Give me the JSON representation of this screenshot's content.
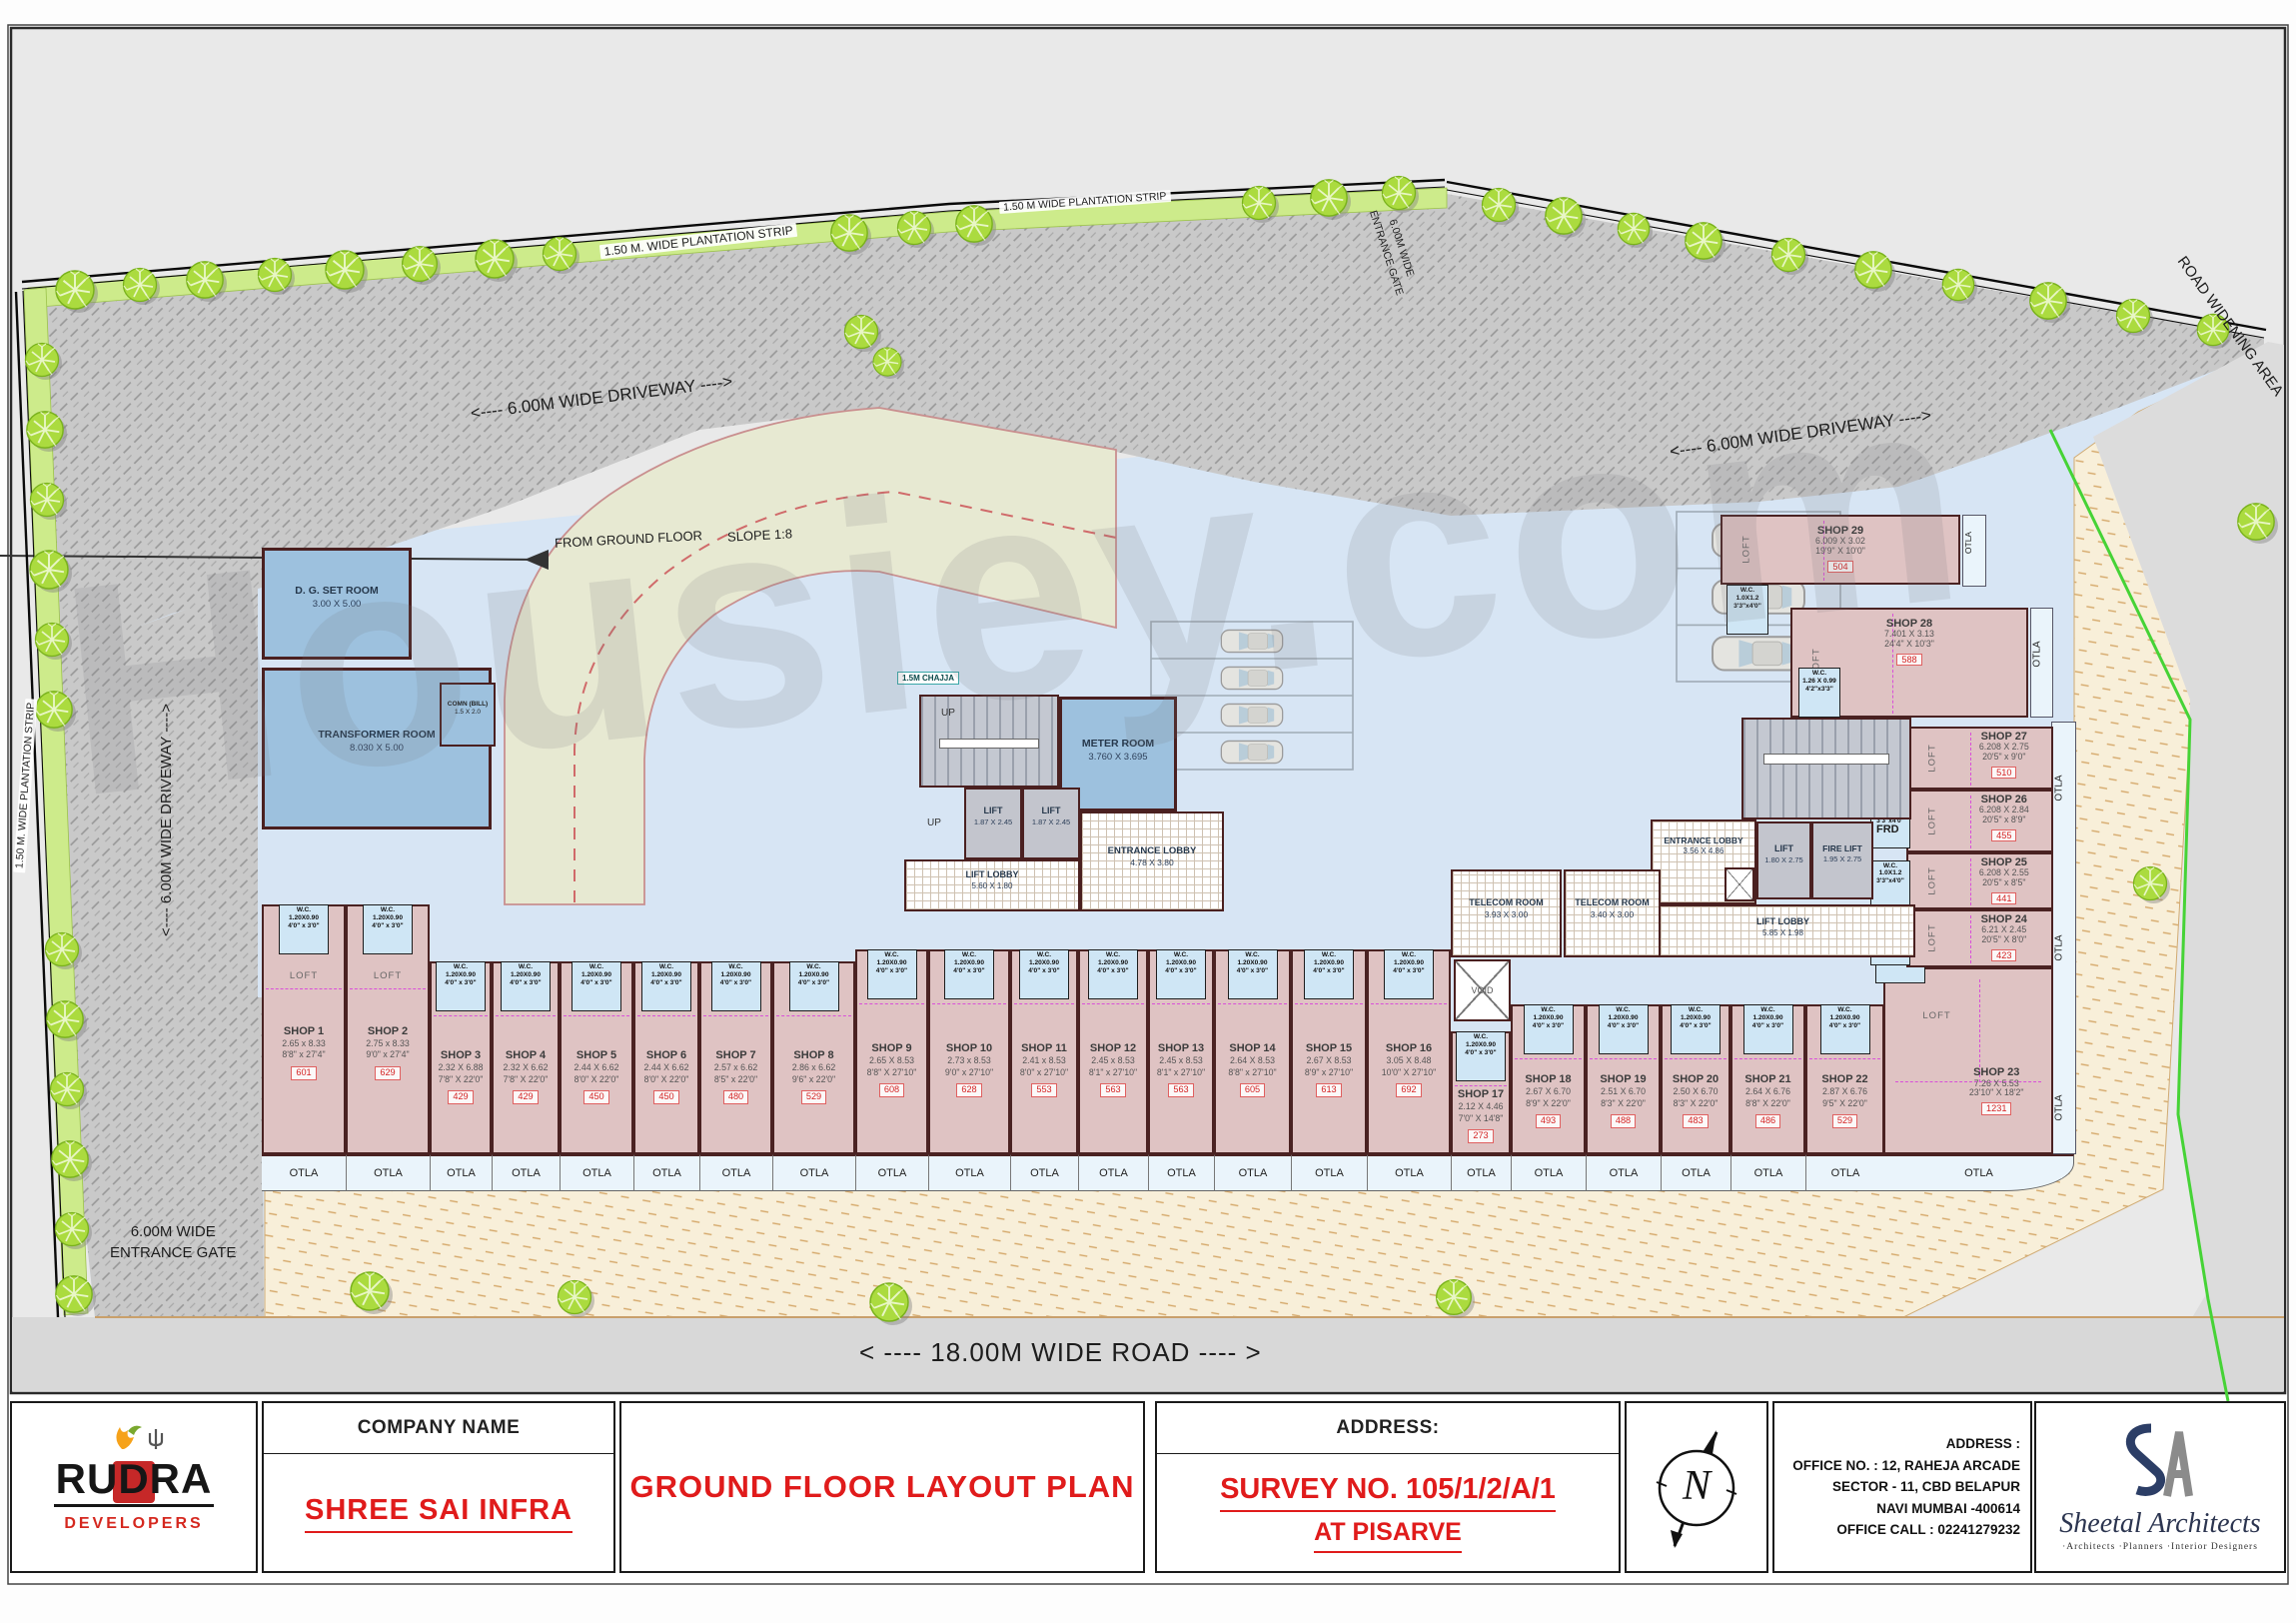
{
  "document": {
    "watermark": "Housiey.com"
  },
  "titleblock": {
    "developer_name": "RUDRA",
    "developer_sub": "DEVELOPERS",
    "company_label": "COMPANY NAME",
    "company_name": "SHREE SAI INFRA",
    "drawing_title": "GROUND FLOOR LAYOUT PLAN",
    "address_label": "ADDRESS:",
    "survey_line1": "SURVEY NO. 105/1/2/A/1",
    "survey_line2": "AT PISARVE",
    "north_letter": "N",
    "architect": {
      "addr_label": "ADDRESS :",
      "addr_line1": "OFFICE NO. : 12, RAHEJA ARCADE",
      "addr_line2": "SECTOR - 11, CBD BELAPUR",
      "addr_line3": "NAVI MUMBAI -400614",
      "addr_line4": "OFFICE CALL : 02241279232",
      "name": "Sheetal Architects",
      "tags": "·Architects    ·Planners    ·Interior Designers"
    }
  },
  "site": {
    "labels": {
      "plantation_strip": "1.50 M. WIDE PLANTATION STRIP",
      "plantation_strip_short": "1.50 M WIDE PLANTATION STRIP",
      "driveway": "<---- 6.00M WIDE DRIVEWAY ---->",
      "ramp_from": "FROM GROUND FLOOR",
      "ramp_slope": "SLOPE 1:8",
      "entrance_gate_line1": "6.00M WIDE",
      "entrance_gate_line2": "ENTRANCE GATE",
      "road_widening": "ROAD WIDENING AREA",
      "road": "< ---- 18.00M WIDE ROAD ---- >",
      "chajja": "1.5M CHAJJA",
      "void": "VOID",
      "frd": "FRD",
      "up": "UP",
      "otla": "OTLA",
      "loft": "LOFT"
    },
    "rooms": {
      "dg": {
        "name": "D. G. SET ROOM",
        "dim": "3.00 X 5.00"
      },
      "transformer": {
        "name": "TRANSFORMER ROOM",
        "dim": "8.030 X 5.00"
      },
      "comn": {
        "name": "COMN (BILL)",
        "dim": "1.5 X 2.0"
      },
      "meter": {
        "name": "METER ROOM",
        "dim": "3.760 X 3.695"
      },
      "telecom1": {
        "name": "TELECOM ROOM",
        "dim": "3.93 X 3.00"
      },
      "telecom2": {
        "name": "TELECOM ROOM",
        "dim": "3.40 X 3.00"
      }
    },
    "core_left": {
      "lift1": {
        "name": "LIFT",
        "dim": "1.87 X 2.45"
      },
      "lift2": {
        "name": "LIFT",
        "dim": "1.87 X 2.45"
      },
      "entrance_lobby": {
        "name": "ENTRANCE LOBBY",
        "dim": "4.78 X 3.80"
      },
      "lift_lobby": {
        "name": "LIFT LOBBY",
        "dim": "5.60 X 1.80"
      }
    },
    "core_right": {
      "lift": {
        "name": "LIFT",
        "dim": "1.80 X 2.75"
      },
      "fire_lift": {
        "name": "FIRE LIFT",
        "dim": "1.95 X 2.75"
      },
      "entrance_lobby": {
        "name": "ENTRANCE LOBBY",
        "dim": "3.56 X 4.86"
      },
      "lift_lobby": {
        "name": "LIFT LOBBY",
        "dim": "5.85 X 1.98"
      }
    },
    "wc": {
      "std": {
        "title": "W.C.",
        "dim": "1.20X0.90",
        "ft": "4'0\" x 3'0\""
      },
      "side": {
        "title": "W.C.",
        "dim": "1.0X1.2",
        "ft": "3'3\"x4'0\""
      },
      "corner": {
        "title": "W.C.",
        "dim": "1.26 X 0.99",
        "ft": "4'2\"x3'3\""
      }
    },
    "shops": [
      {
        "label": "SHOP 1",
        "m": "2.65 x 8.33",
        "ft": "8'8\" x 27'4\"",
        "area": "601"
      },
      {
        "label": "SHOP 2",
        "m": "2.75 x 8.33",
        "ft": "9'0\" x 27'4\"",
        "area": "629"
      },
      {
        "label": "SHOP 3",
        "m": "2.32 X 6.88",
        "ft": "7'8\" X 22'0\"",
        "area": "429"
      },
      {
        "label": "SHOP 4",
        "m": "2.32 X 6.62",
        "ft": "7'8\" X 22'0\"",
        "area": "429"
      },
      {
        "label": "SHOP 5",
        "m": "2.44 X 6.62",
        "ft": "8'0\" X 22'0\"",
        "area": "450"
      },
      {
        "label": "SHOP 6",
        "m": "2.44 X 6.62",
        "ft": "8'0\" X 22'0\"",
        "area": "450"
      },
      {
        "label": "SHOP 7",
        "m": "2.57 x 6.62",
        "ft": "8'5\" x 22'0\"",
        "area": "480"
      },
      {
        "label": "SHOP 8",
        "m": "2.86 x 6.62",
        "ft": "9'6\" x 22'0\"",
        "area": "529"
      },
      {
        "label": "SHOP 9",
        "m": "2.65 X 8.53",
        "ft": "8'8\" X 27'10\"",
        "area": "608"
      },
      {
        "label": "SHOP 10",
        "m": "2.73 x 8.53",
        "ft": "9'0\" x 27'10\"",
        "area": "628"
      },
      {
        "label": "SHOP 11",
        "m": "2.41 x 8.53",
        "ft": "8'0\" x 27'10\"",
        "area": "553"
      },
      {
        "label": "SHOP 12",
        "m": "2.45 x 8.53",
        "ft": "8'1\" x 27'10\"",
        "area": "563"
      },
      {
        "label": "SHOP 13",
        "m": "2.45 x 8.53",
        "ft": "8'1\" x 27'10\"",
        "area": "563"
      },
      {
        "label": "SHOP 14",
        "m": "2.64 X 8.53",
        "ft": "8'8\" x 27'10\"",
        "area": "605"
      },
      {
        "label": "SHOP 15",
        "m": "2.67 X 8.53",
        "ft": "8'9\" x 27'10\"",
        "area": "613"
      },
      {
        "label": "SHOP 16",
        "m": "3.05 X 8.48",
        "ft": "10'0\" X 27'10\"",
        "area": "692"
      },
      {
        "label": "SHOP 17",
        "m": "2.12 X 4.46",
        "ft": "7'0\" X 14'8\"",
        "area": "273"
      },
      {
        "label": "SHOP 18",
        "m": "2.67 X 6.70",
        "ft": "8'9\" X 22'0\"",
        "area": "493"
      },
      {
        "label": "SHOP 19",
        "m": "2.51 X 6.70",
        "ft": "8'3\" X 22'0\"",
        "area": "488"
      },
      {
        "label": "SHOP 20",
        "m": "2.50 X 6.70",
        "ft": "8'3\" X 22'0\"",
        "area": "483"
      },
      {
        "label": "SHOP 21",
        "m": "2.64 X 6.76",
        "ft": "8'8\" X 22'0\"",
        "area": "486"
      },
      {
        "label": "SHOP 22",
        "m": "2.87 X 6.76",
        "ft": "9'5\" X 22'0\"",
        "area": "529"
      },
      {
        "label": "SHOP 23",
        "m": "7.26 X 5.53",
        "ft": "23'10\" X 18'2\"",
        "area": "1231"
      },
      {
        "label": "SHOP 24",
        "m": "6.21 X 2.45",
        "ft": "20'5\" X 8'0\"",
        "area": "423"
      },
      {
        "label": "SHOP 25",
        "m": "6.208 X 2.55",
        "ft": "20'5\" x 8'5\"",
        "area": "441"
      },
      {
        "label": "SHOP 26",
        "m": "6.208 X 2.84",
        "ft": "20'5\" x 8'9\"",
        "area": "455"
      },
      {
        "label": "SHOP 27",
        "m": "6.208 X 2.75",
        "ft": "20'5\" x 9'0\"",
        "area": "510"
      },
      {
        "label": "SHOP 28",
        "m": "7.401 X 3.13",
        "ft": "24'4\" X 10'3\"",
        "area": "588"
      },
      {
        "label": "SHOP 29",
        "m": "6.009 X 3.02",
        "ft": "19'9\" X 10'0\"",
        "area": "504"
      }
    ]
  }
}
